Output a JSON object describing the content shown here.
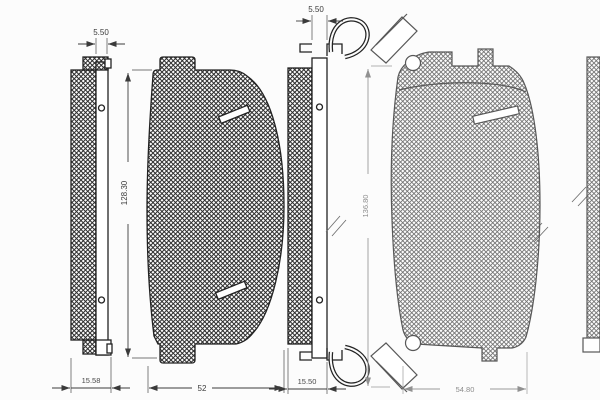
{
  "drawing": {
    "pad1_side": {
      "top_dim": "5.50",
      "bottom_dim": "15.58"
    },
    "pad1_front": {
      "height_dim": "128.30",
      "width_dim": "52"
    },
    "pad2_side": {
      "top_dim": "5.50",
      "bottom_dim": "15.50"
    },
    "pad2_front": {
      "height_dim": "136.80",
      "width_dim": "54.80"
    }
  }
}
